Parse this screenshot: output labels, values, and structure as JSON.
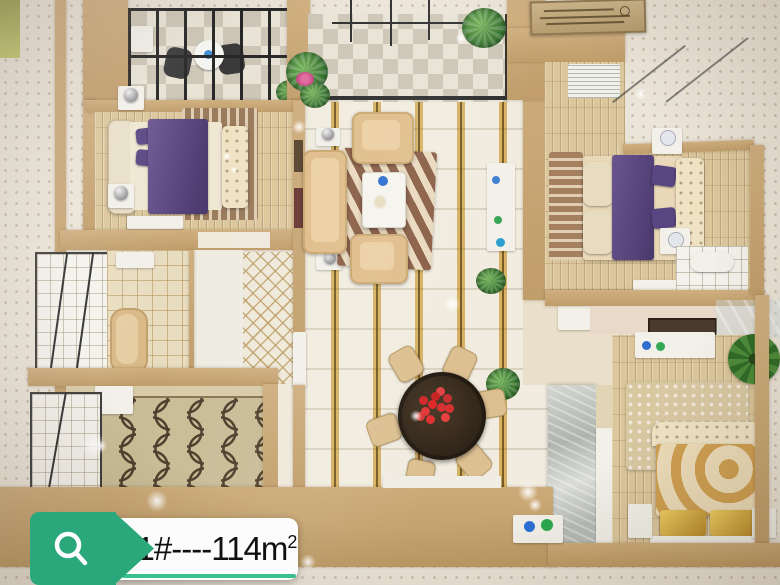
{
  "badge": {
    "text": "11#----114m",
    "sup": "2",
    "full_label": "11#----114m²",
    "icon": "search-icon",
    "green": "#2aa87b",
    "underline_green": "#3bc18e",
    "text_color": "#101010",
    "background": "#fcfcfc"
  },
  "palette": {
    "outer_floor": "#ebe4d8",
    "wall_tan": "#c7a571",
    "wood_floor": "#dcc79c",
    "tile_gold_stripe": "#d7b264",
    "bed_purple": "#5e4c82",
    "sofa_beige": "#e0bd8c",
    "dining_table_dark": "#3a2d20",
    "flower_red": "#e02828",
    "gold_bed": "#d9b86a",
    "marble_grey": "#c3c7c2",
    "plant_green": "#4d8a3a",
    "railing_black": "#2e2e2e"
  },
  "scene": {
    "type": "photo-of-apartment-scale-model",
    "view": "top-down",
    "rooms_visible": [
      "balcony-with-railing-top-left",
      "bedroom-purple-bed-top-left",
      "living-room-with-sofa-set-and-zebra-rug-center",
      "balcony-with-plants-top-center",
      "bedroom-purple-bed-top-right",
      "bathroom-shower-left",
      "kitchen-ogee-tile-bottom-left",
      "hallway-diamond-tile-center-left",
      "dining-round-table-red-flowers-center-bottom",
      "bedroom-gold-bed-bottom-right",
      "ensuite-bathroom-right"
    ],
    "plaque": "small-unreadable-sign-top-center"
  }
}
